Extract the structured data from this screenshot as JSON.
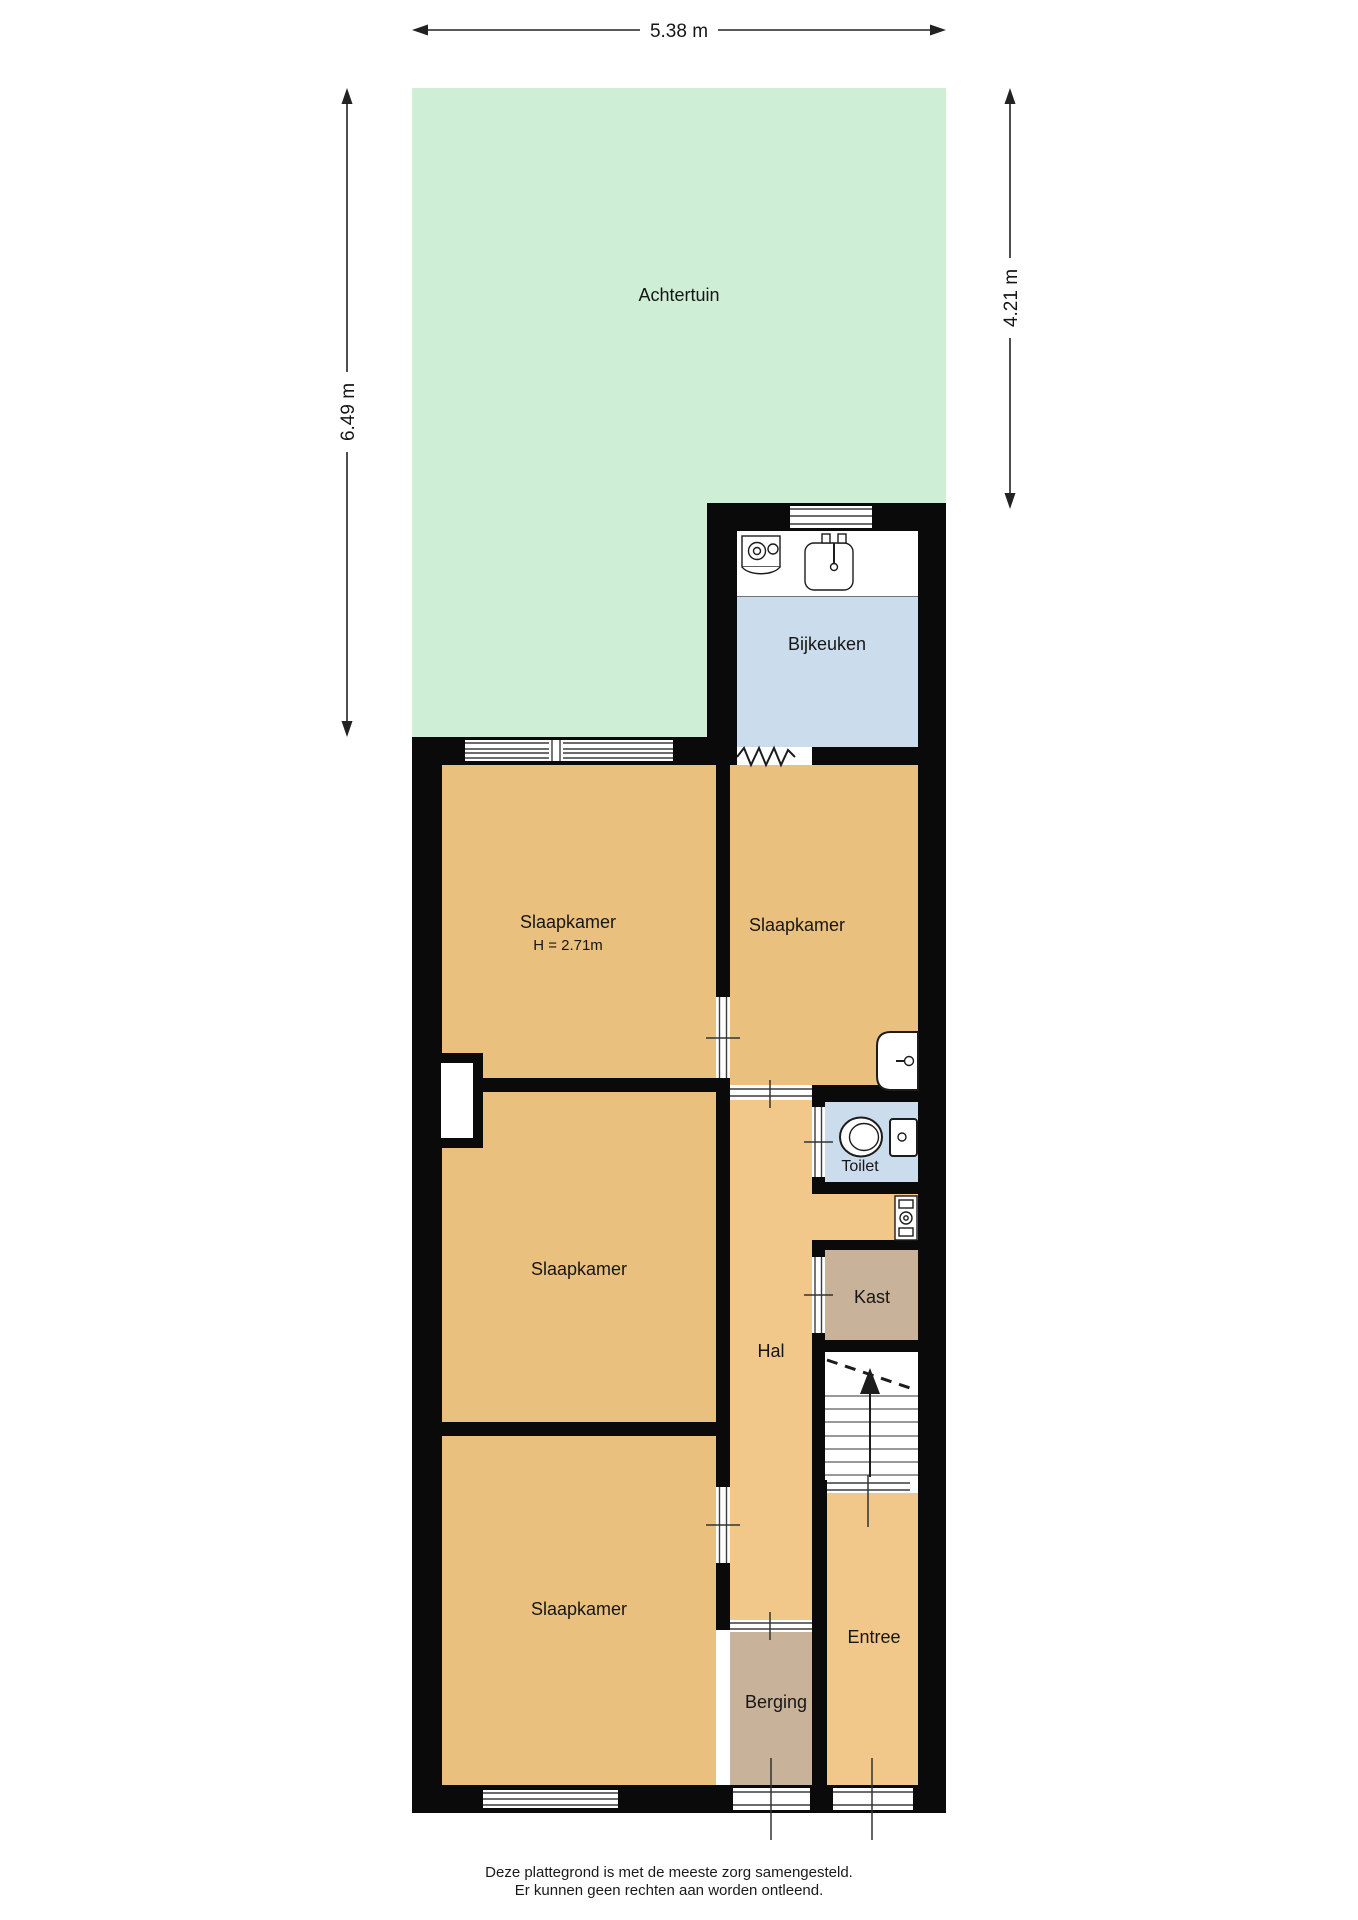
{
  "dimensions": {
    "top": "5.38 m",
    "left": "6.49 m",
    "right": "4.21 m"
  },
  "rooms": {
    "achtertuin": {
      "label": "Achtertuin"
    },
    "bijkeuken": {
      "label": "Bijkeuken"
    },
    "slaapkamer_1": {
      "label": "Slaapkamer",
      "height_note": "H = 2.71m"
    },
    "slaapkamer_2": {
      "label": "Slaapkamer"
    },
    "slaapkamer_3": {
      "label": "Slaapkamer"
    },
    "slaapkamer_4": {
      "label": "Slaapkamer"
    },
    "toilet": {
      "label": "Toilet"
    },
    "kast": {
      "label": "Kast"
    },
    "hal": {
      "label": "Hal"
    },
    "entree": {
      "label": "Entree"
    },
    "berging": {
      "label": "Berging"
    }
  },
  "footer": {
    "line1": "Deze plattegrond is met de meeste zorg samengesteld.",
    "line2": "Er kunnen geen rechten aan worden ontleend."
  },
  "icons": [
    "washing-machine-icon",
    "kitchen-sink-icon",
    "toilet-icon",
    "cistern-icon",
    "wash-basin-icon",
    "boiler-icon",
    "stairs-up-arrow-icon",
    "open-connection-zigzag-icon"
  ],
  "colors": {
    "garden": "#cfeed6",
    "bedroom": "#e9c07e",
    "hall": "#f1c78a",
    "wet_room": "#cbdcec",
    "storage": "#c8b299",
    "wall": "#0a0a0a",
    "stairs": "#ffffff"
  }
}
